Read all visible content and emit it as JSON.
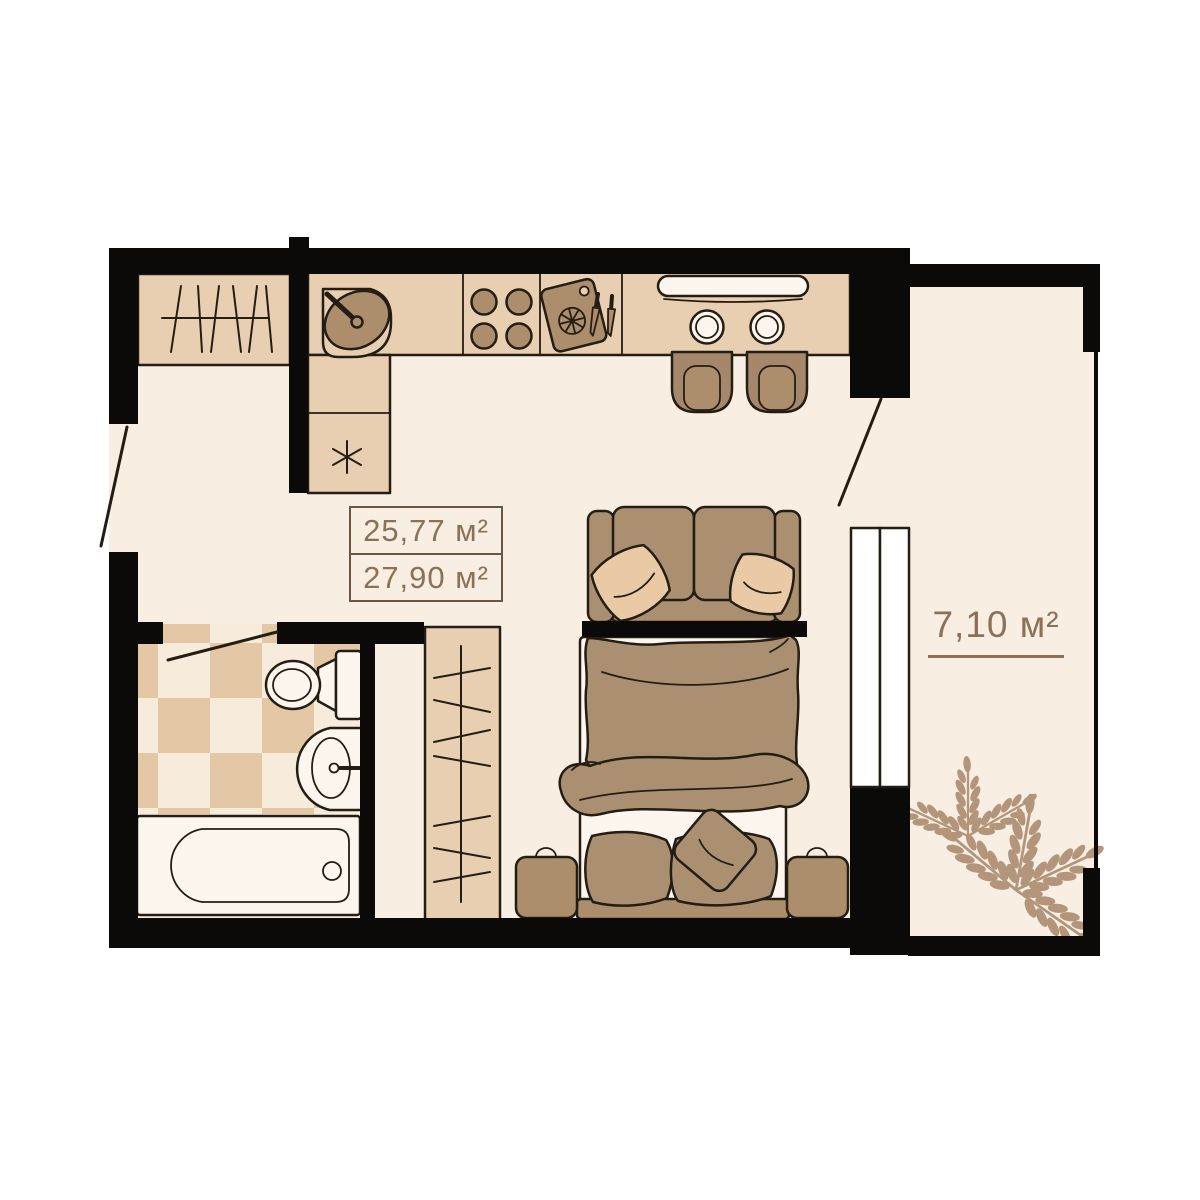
{
  "areas": {
    "living": "25,77 м²",
    "total": "27,90 м²",
    "balcony": "7,10 м²"
  },
  "colors": {
    "wall": "#0c0a08",
    "floor": "#f8eee1",
    "outline": "#241d14",
    "tanLight": "#e9cfb1",
    "tanMid": "#ac8e6d",
    "chair": "#a5886b",
    "upholstery": "#aa9071",
    "pillow": "#e9caa4",
    "fixture": "#fdf6ee",
    "checkerTan": "#e4c7a5",
    "checkerCream": "#f7ecdc",
    "leaf": "#b2957a",
    "labelText": "#8a7157",
    "boxBorder": "#6a5741"
  },
  "furniture_icons": [
    "entry-wardrobe-icon",
    "kitchen-corner-sink-icon",
    "stove-burners-icon",
    "cutting-board-icon",
    "knives-icon",
    "serving-dish-icon",
    "plate-icon",
    "dining-chair-icon",
    "washing-unit-asterisk-icon",
    "sofa-icon",
    "double-bed-icon",
    "nightstand-icon",
    "tall-wardrobe-icon",
    "toilet-icon",
    "washbasin-icon",
    "bathtub-icon",
    "window-icon",
    "door-swing-icon",
    "plant-icon"
  ]
}
